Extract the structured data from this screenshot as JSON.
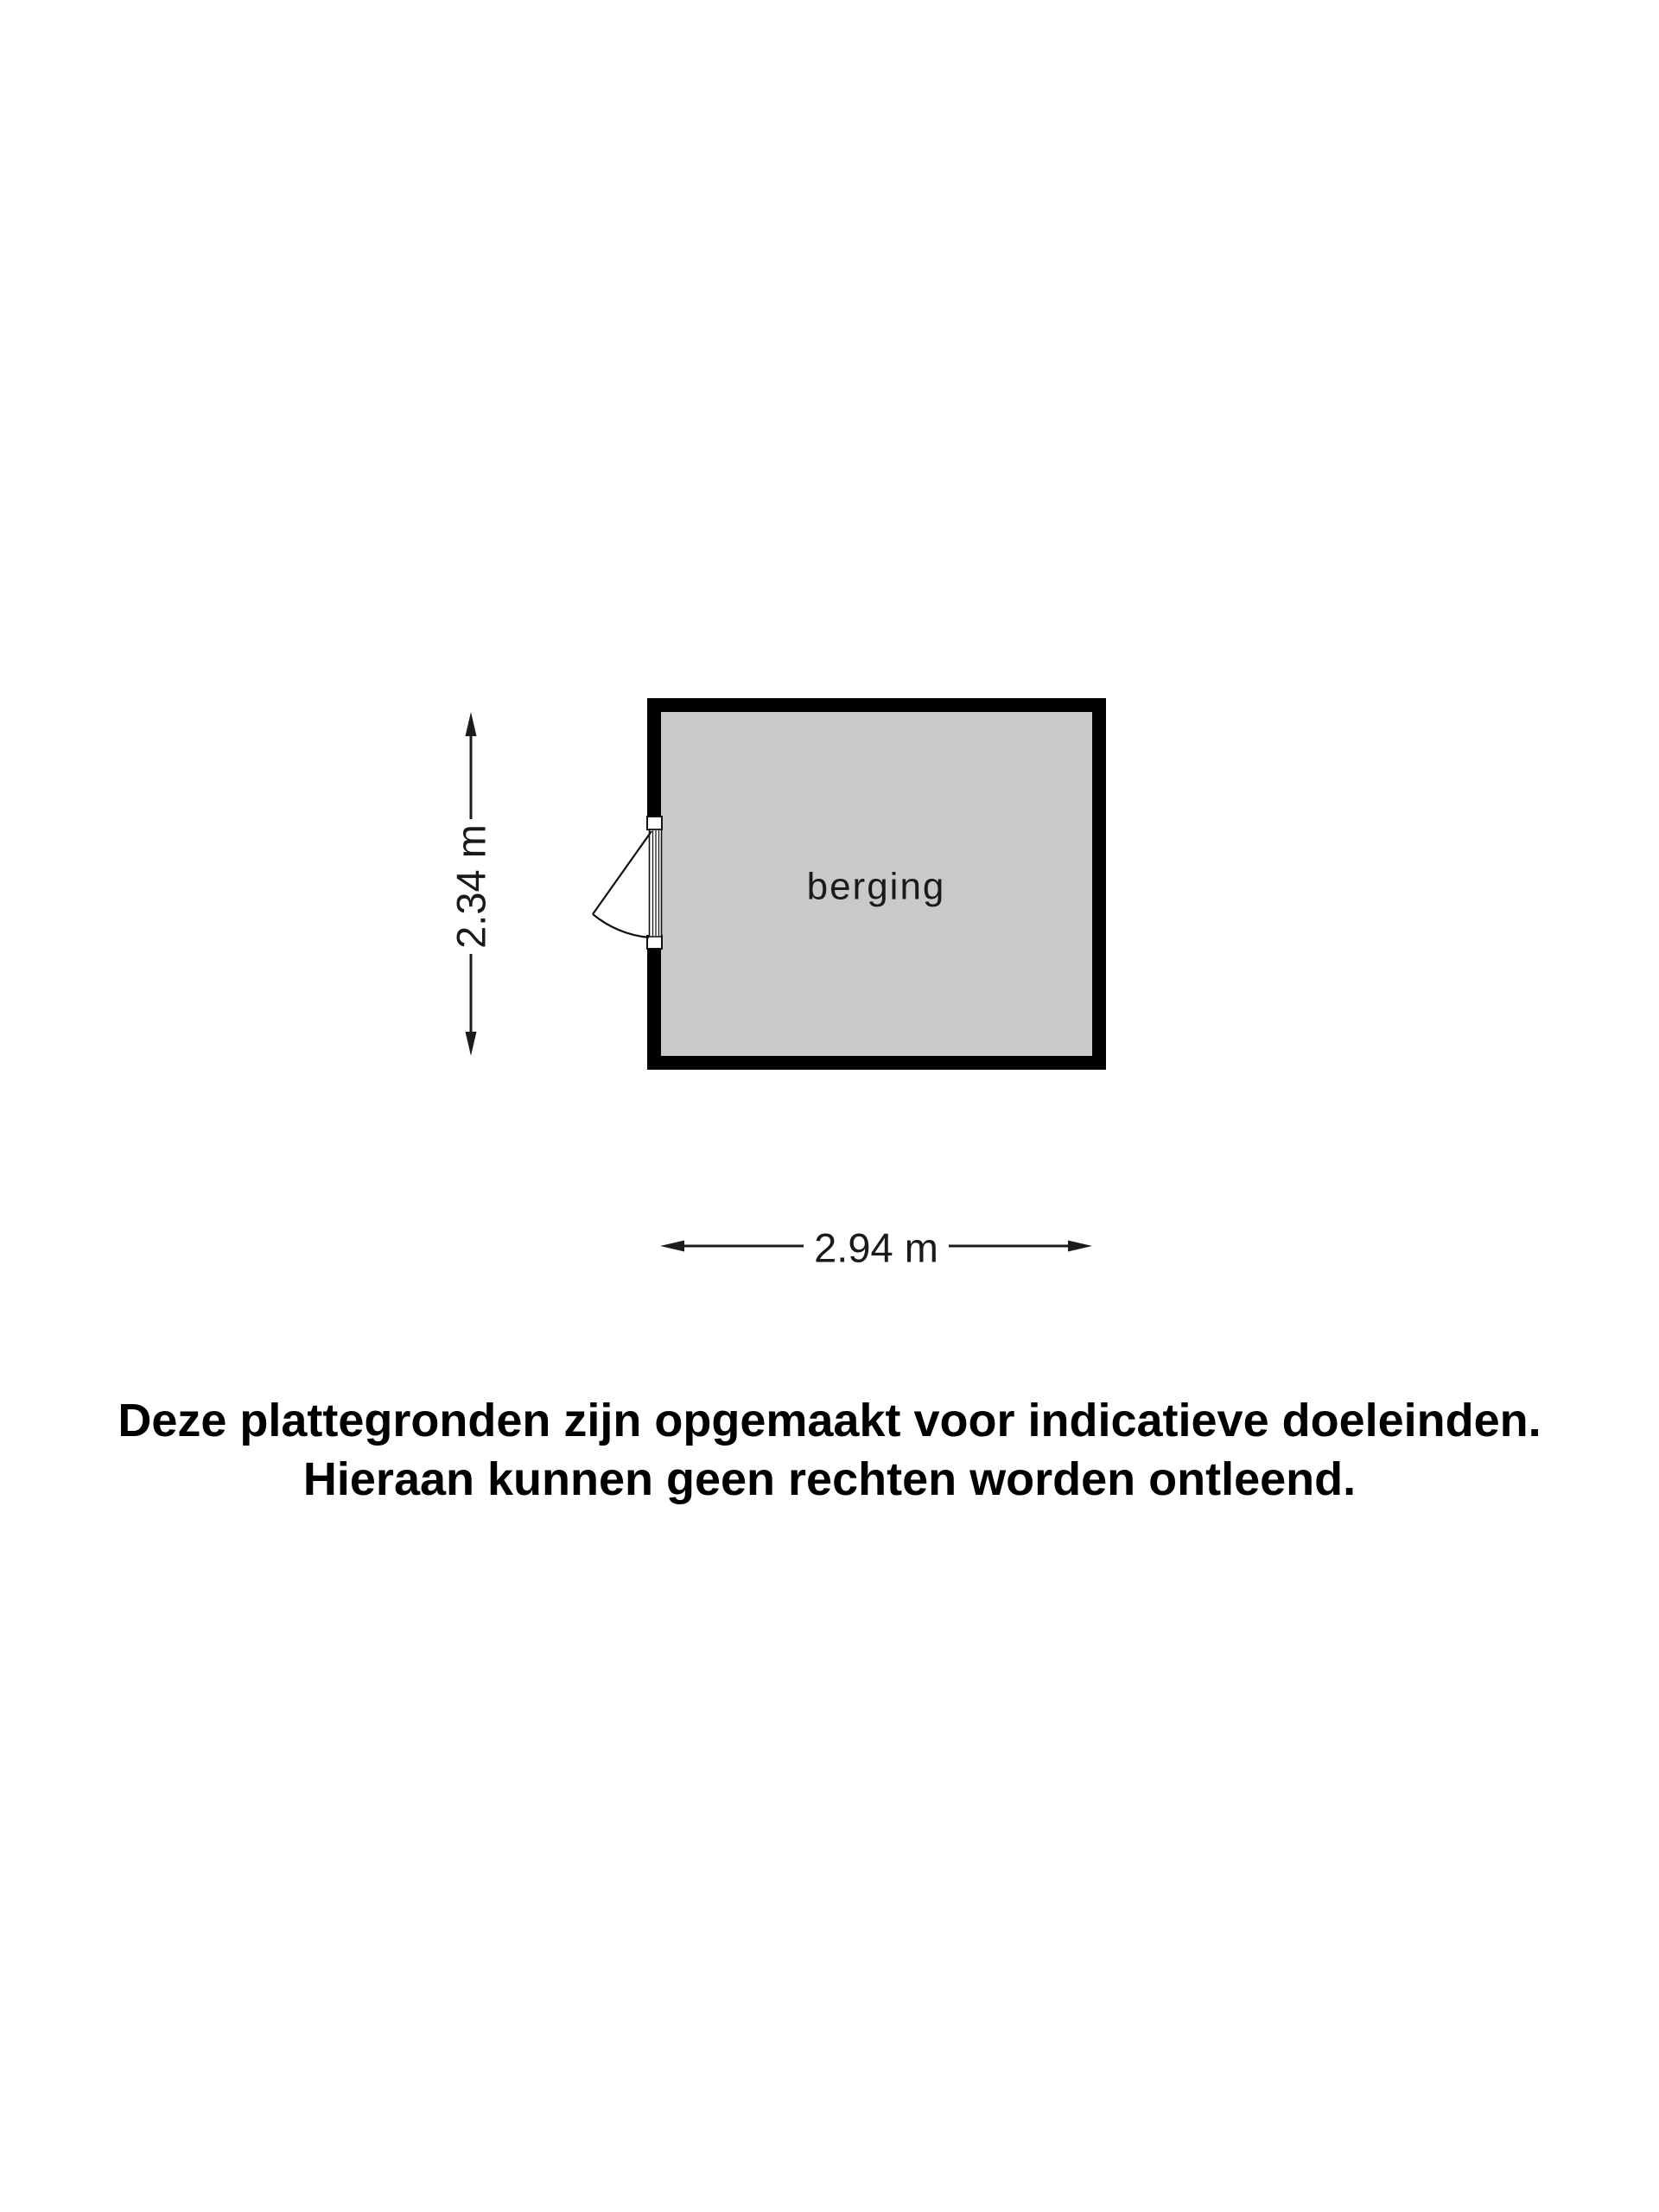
{
  "floor_plan": {
    "room": {
      "label": "berging"
    },
    "dimensions": {
      "height": "2.34 m",
      "width": "2.94 m"
    }
  },
  "disclaimer": {
    "line1": "Deze plattegronden zijn opgemaakt voor indicatieve doeleinden.",
    "line2": "Hieraan kunnen geen rechten worden ontleend."
  },
  "colors": {
    "wall": "#000000",
    "room_fill": "#c9c9c9",
    "line_and_text": "#1a1a1a",
    "background": "#ffffff"
  }
}
